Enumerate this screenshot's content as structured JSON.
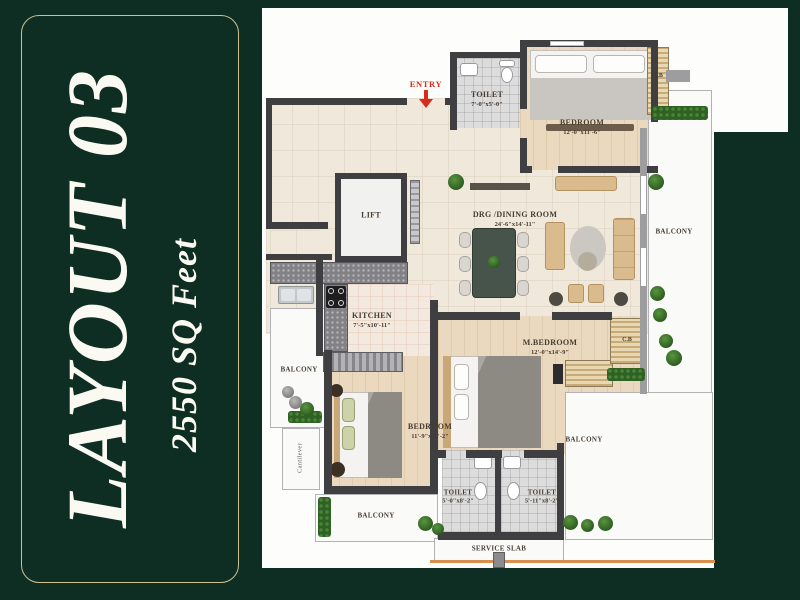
{
  "panel": {
    "title": "LAYOUT 03",
    "subtitle": "2550 SQ Feet"
  },
  "plan": {
    "entry_label": "ENTRY",
    "rooms": {
      "toilet_top": {
        "name": "TOILET",
        "dims": "7'-0\"x5'-0\""
      },
      "bedroom_top": {
        "name": "BEDROOM",
        "dims": "12'-0\"x11'-6\""
      },
      "lift": {
        "name": "LIFT"
      },
      "drg_dining": {
        "name": "DRG /DINING ROOM",
        "dims": "24'-6\"x14'-11\""
      },
      "kitchen": {
        "name": "KITCHEN",
        "dims": "7'-5\"x10'-11\""
      },
      "m_bedroom": {
        "name": "M.BEDROOM",
        "dims": "12'-0\"x14'-9\""
      },
      "bedroom_2": {
        "name": "BEDROOM",
        "dims": "11'-9\"x12'-2\""
      },
      "toilet_bottom_left": {
        "name": "TOILET",
        "dims": "5'-0\"x8'-2\""
      },
      "toilet_bottom_right": {
        "name": "TOILET",
        "dims": "5'-11\"x8'-2\""
      },
      "balcony_left": {
        "name": "BALCONY"
      },
      "balcony_bottom": {
        "name": "BALCONY"
      },
      "balcony_right": {
        "name": "BALCONY"
      },
      "balcony_right_lower": {
        "name": "BALCONY"
      },
      "cantilever": {
        "name": "Cantilever"
      },
      "service_slab": {
        "name": "SERVICE SLAB"
      },
      "cupboard_top": {
        "name": "C.B"
      },
      "cupboard_mid": {
        "name": "C.B"
      }
    }
  },
  "colors": {
    "background": "#0e2e23",
    "panel_border": "#cfc08f",
    "entry_red": "#d92b1c",
    "wall_dark": "#3f3f41",
    "floor_tile": "#f0e9db",
    "floor_wood": "#ead9bf",
    "plant_green": "#2f6125"
  }
}
